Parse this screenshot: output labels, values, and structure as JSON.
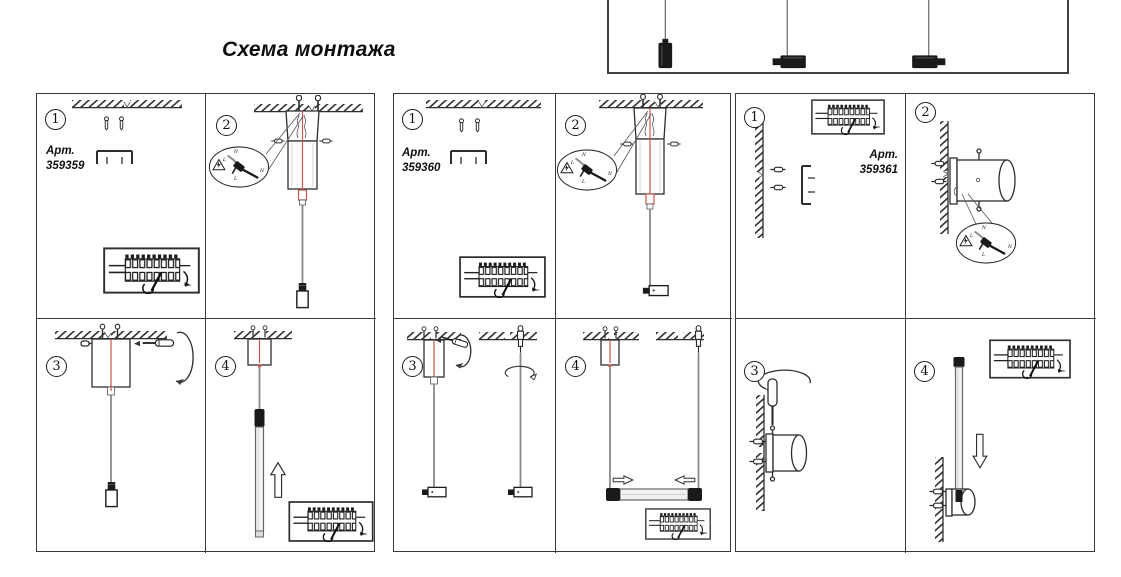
{
  "title": "Схема монтажа",
  "colors": {
    "cable_red": "#c4574e",
    "diagram_line": "#2e2e2e"
  },
  "labels": {
    "art_prefix": "Арт.",
    "wire_n": "N",
    "wire_l": "L",
    "torque_note": "макс."
  },
  "panels": [
    {
      "art": "359359",
      "steps": [
        "1",
        "2",
        "3",
        "4"
      ]
    },
    {
      "art": "359360",
      "steps": [
        "1",
        "2",
        "3",
        "4"
      ]
    },
    {
      "art": "359361",
      "steps": [
        "1",
        "2",
        "3",
        "4"
      ]
    }
  ]
}
